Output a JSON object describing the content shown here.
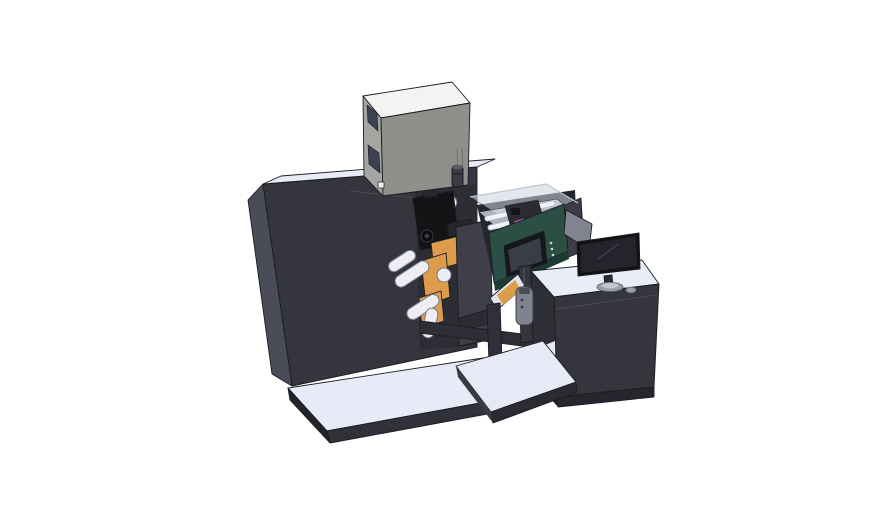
{
  "scene": {
    "description": "Isometric 3D CAD render of an industrial web printing / rewinding machine line with an operator workstation, on a plain white background",
    "parts": [
      {
        "id": "main-cabinet",
        "label": "main machine cabinet"
      },
      {
        "id": "base-platform",
        "label": "machine base platform"
      },
      {
        "id": "electronics-box",
        "label": "top-mounted electronics box"
      },
      {
        "id": "web-mechanism",
        "label": "web path mechanism with guide rollers and orange plates"
      },
      {
        "id": "print-head",
        "label": "black print-head assembly"
      },
      {
        "id": "inspection-module",
        "label": "transparent inspection enclosure with white rails"
      },
      {
        "id": "control-box",
        "label": "green control box with HMI touch panel"
      },
      {
        "id": "outfeed-conveyor",
        "label": "inclined outfeed ramp with material web"
      },
      {
        "id": "pendant-remote",
        "label": "hanging pendant remote"
      },
      {
        "id": "workstation-desk",
        "label": "operator workstation desk"
      },
      {
        "id": "monitor",
        "label": "desktop monitor on oval stand"
      },
      {
        "id": "rear-panel",
        "label": "rear display panel seen from behind"
      }
    ]
  },
  "colors": {
    "background": "#ffffff",
    "machine_front": "#35353e",
    "machine_side": "#4a4c57",
    "machine_top": "#e8ecf7",
    "base_top": "#e6ebf7",
    "base_side": "#31313a",
    "base_edge": "#23232b",
    "bay_recess": "#2d2d35",
    "bay_cover": "#3f3f49",
    "link_dark": "#2c2c34",
    "orange": "#dd9c4b",
    "roller": "#eceef4",
    "roller_stroke": "#787c88",
    "black_part": "#141417",
    "black_part2": "#26262c",
    "knob_dark": "#0c0c0f",
    "knob_inner": "#3c3c45",
    "box_top": "#f3f3f1",
    "box_left": "#a5a5a1",
    "box_front": "#8f8f8b",
    "box_window": "#3d4250",
    "box_foot": "#f0f0ee",
    "cylinder": "#3a3b43",
    "cylinder_cap": "#5a5b64",
    "under_box": "#262630",
    "glass": "#ccd3df",
    "glass_floor": "#dde3ee",
    "rail_white": "#f2f3f7",
    "internals_dark": "#2b2b31",
    "internal_bit": "#15151a",
    "magenta": "#c75fc9",
    "glass_end": "#3c3c46",
    "green_face": "#2b4f45",
    "green_dark": "#1e3a33",
    "hmi_bezel": "#17171b",
    "hmi_screen": "#3a3d46",
    "hmi_dot": "#cfd5d0",
    "beam_dark": "#2e2e36",
    "post_dark": "#34343d",
    "ramp_light": "#dfe3ee",
    "leg_dark": "#30303a",
    "shelf_light": "#e6eaf6",
    "shelf_front": "#2b2b33",
    "shelf_side": "#3a3a44",
    "pendant": "#80838f",
    "pendant_cap": "#4a4d56",
    "desk_top": "#e9edf8",
    "desk_front": "#35353e",
    "desk_left": "#2e2e37",
    "desk_base": "#26262e",
    "desk_base_left": "#1c1c23",
    "panel_back": "#81848f",
    "monitor_body": "#121216",
    "monitor_screen": "#24242c",
    "monitor_neck": "#2c2c33",
    "monitor_stand": "#9aa0ad",
    "stand_top": "#c2c7d1",
    "mouse": "#9aa0ac"
  }
}
